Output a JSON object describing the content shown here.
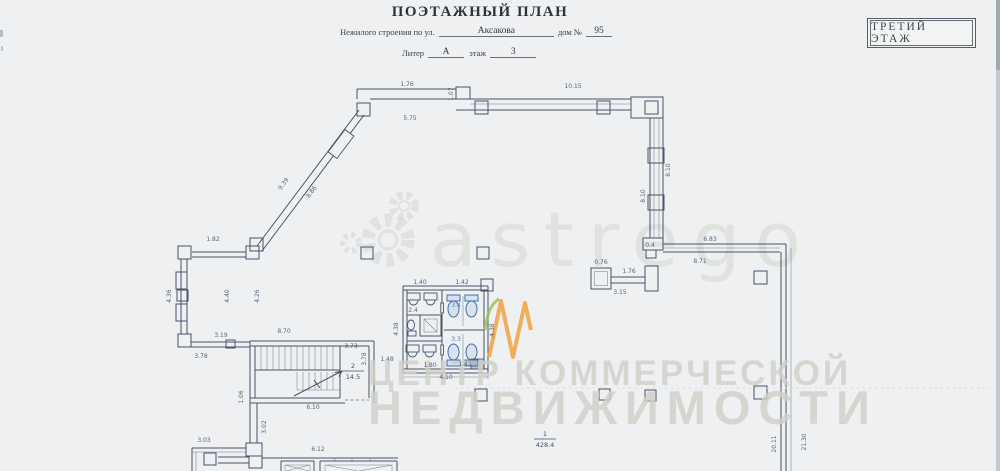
{
  "page": {
    "title": "ПОЭТАЖНЫЙ ПЛАН",
    "form": {
      "line1_label": "Нежилого строения по ул.",
      "line1_value": "Аксакова",
      "line1_label2": "дом №",
      "line1_value2": "95",
      "line2_label": "Литер",
      "line2_value": "А",
      "line2_label2": "этаж",
      "line2_value2": "3"
    },
    "stamp": "ТРЕТИЙ ЭТАЖ"
  },
  "watermark": {
    "brand": "astrego",
    "line1": "ЦЕНТР КОММЕРЧЕСКОЙ",
    "line2": "НЕДВИЖИМОСТИ",
    "colors": {
      "gray": "#d5d7d3",
      "text_gray": "#d2cfc9",
      "orange": "#f0a23f",
      "green": "#97c04f"
    }
  },
  "plan": {
    "colors": {
      "ink": "#46536b",
      "fixture_blue": "#3f6fb5",
      "paper": "#eef0f1"
    },
    "room_labels": [
      {
        "num": "2",
        "area": "14.5",
        "x": 353,
        "y": 368
      },
      {
        "num": "1",
        "area": "428.4",
        "x": 545,
        "y": 436
      }
    ],
    "dimensions": [
      {
        "t": "1.76",
        "x": 407,
        "y": 86
      },
      {
        "t": "1.07",
        "x": 453,
        "y": 94,
        "r": -90
      },
      {
        "t": "10.15",
        "x": 573,
        "y": 88
      },
      {
        "t": "5.75",
        "x": 410,
        "y": 120
      },
      {
        "t": "9.39",
        "x": 285,
        "y": 185,
        "r": -53
      },
      {
        "t": "8.86",
        "x": 313,
        "y": 193,
        "r": -53
      },
      {
        "t": "1.82",
        "x": 213,
        "y": 241
      },
      {
        "t": "8.10",
        "x": 645,
        "y": 196,
        "r": -90
      },
      {
        "t": "8.10",
        "x": 670,
        "y": 170,
        "r": -90
      },
      {
        "t": "0.4",
        "x": 650,
        "y": 247
      },
      {
        "t": "6.83",
        "x": 710,
        "y": 241
      },
      {
        "t": "8.71",
        "x": 700,
        "y": 263
      },
      {
        "t": "0.76",
        "x": 601,
        "y": 264
      },
      {
        "t": "1.76",
        "x": 629,
        "y": 273
      },
      {
        "t": "3.15",
        "x": 620,
        "y": 294
      },
      {
        "t": "20.11",
        "x": 776,
        "y": 444,
        "r": -90
      },
      {
        "t": "21.30",
        "x": 806,
        "y": 442,
        "r": -90
      },
      {
        "t": "4.36",
        "x": 171,
        "y": 296,
        "r": -90
      },
      {
        "t": "4.40",
        "x": 229,
        "y": 296,
        "r": -90
      },
      {
        "t": "4.26",
        "x": 259,
        "y": 296,
        "r": -90
      },
      {
        "t": "3.19",
        "x": 221,
        "y": 337
      },
      {
        "t": "3.78",
        "x": 201,
        "y": 358
      },
      {
        "t": "8.70",
        "x": 284,
        "y": 333
      },
      {
        "t": "3.73",
        "x": 351,
        "y": 348
      },
      {
        "t": "3.78",
        "x": 366,
        "y": 359,
        "r": -90
      },
      {
        "t": "1.48",
        "x": 387,
        "y": 361
      },
      {
        "t": "6.10",
        "x": 313,
        "y": 409
      },
      {
        "t": "1.06",
        "x": 243,
        "y": 397,
        "r": -90
      },
      {
        "t": "3.02",
        "x": 266,
        "y": 427,
        "r": -90
      },
      {
        "t": "3.03",
        "x": 204,
        "y": 442
      },
      {
        "t": "6.12",
        "x": 318,
        "y": 451
      },
      {
        "t": "4.38",
        "x": 398,
        "y": 329,
        "r": -90
      },
      {
        "t": "4.38",
        "x": 494,
        "y": 330,
        "r": -90
      },
      {
        "t": "4.10",
        "x": 446,
        "y": 379
      },
      {
        "t": "1.40",
        "x": 420,
        "y": 284
      },
      {
        "t": "1.42",
        "x": 462,
        "y": 284
      },
      {
        "t": "1.80",
        "x": 430,
        "y": 367
      },
      {
        "t": "1.42",
        "x": 465,
        "y": 366
      },
      {
        "t": "3.4",
        "x": 456,
        "y": 307,
        "c": 1
      },
      {
        "t": "3.3",
        "x": 456,
        "y": 341,
        "c": 1
      },
      {
        "t": "2.4",
        "x": 413,
        "y": 312
      }
    ]
  }
}
